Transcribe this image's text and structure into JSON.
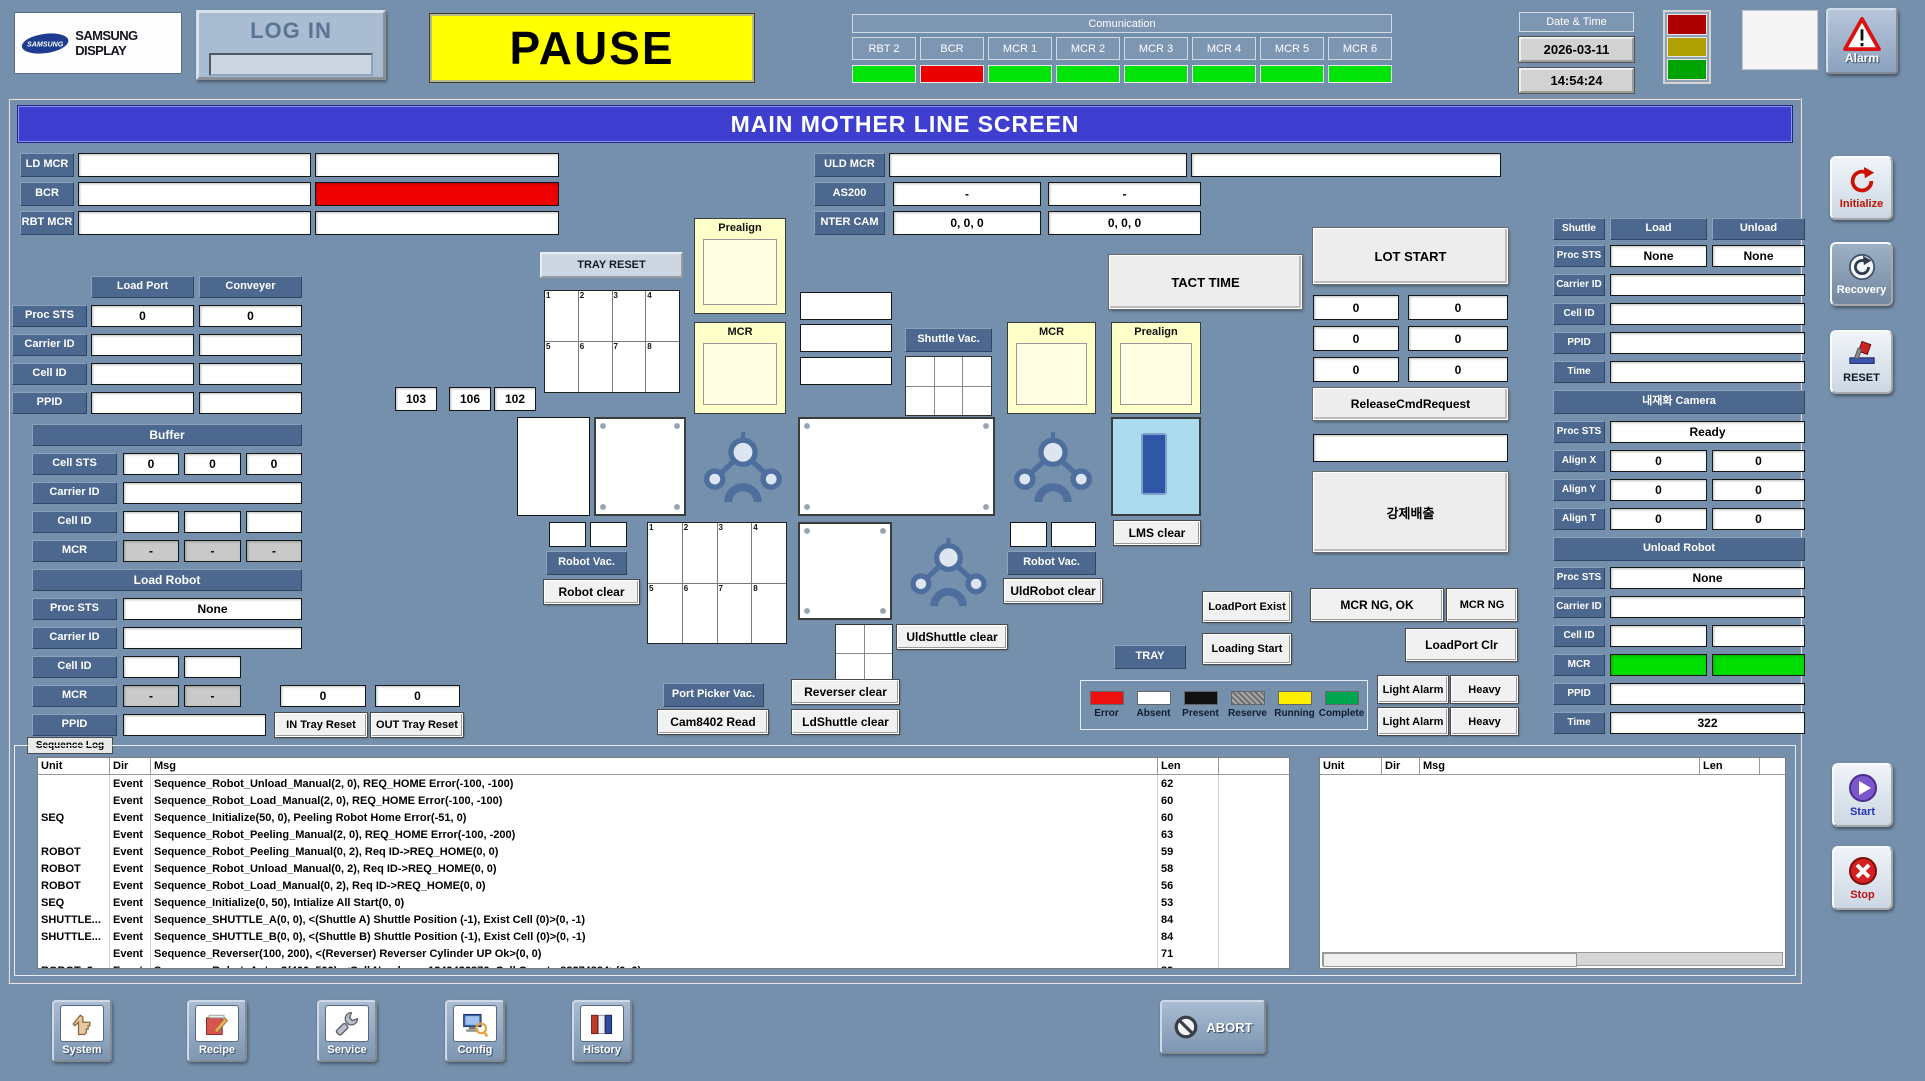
{
  "header": {
    "logo": {
      "oval_text": "SAMSUNG",
      "brand": "SAMSUNG DISPLAY"
    },
    "login_label": "LOG IN",
    "run_status": "PAUSE",
    "comm": {
      "title": "Comunication",
      "channels": [
        {
          "label": "RBT 2",
          "state": "ok"
        },
        {
          "label": "BCR",
          "state": "error"
        },
        {
          "label": "MCR 1",
          "state": "ok"
        },
        {
          "label": "MCR 2",
          "state": "ok"
        },
        {
          "label": "MCR 3",
          "state": "ok"
        },
        {
          "label": "MCR 4",
          "state": "ok"
        },
        {
          "label": "MCR 5",
          "state": "ok"
        },
        {
          "label": "MCR 6",
          "state": "ok"
        }
      ]
    },
    "datetime": {
      "title": "Date & Time",
      "date": "2026-03-11",
      "time": "14:54:24"
    },
    "alarm_label": "Alarm"
  },
  "title": "MAIN MOTHER LINE SCREEN",
  "id_rows": {
    "ld_mcr": {
      "label": "LD MCR",
      "v1": "",
      "v2": ""
    },
    "bcr": {
      "label": "BCR",
      "v1": "",
      "v2": ""
    },
    "rbt_mcr": {
      "label": "RBT MCR",
      "v1": "",
      "v2": ""
    },
    "uld_mcr": {
      "label": "ULD MCR",
      "v1": "",
      "v2": ""
    },
    "as200": {
      "label": "AS200",
      "v1": "-",
      "v2": "-"
    },
    "nter_cam": {
      "label": "NTER CAM",
      "v1": "0, 0, 0",
      "v2": "0, 0, 0"
    }
  },
  "load_port": {
    "col1": "Load Port",
    "col2": "Conveyer",
    "proc_sts_label": "Proc STS",
    "carrier_id_label": "Carrier ID",
    "cell_id_label": "Cell ID",
    "ppid_label": "PPID",
    "proc_sts": [
      "0",
      "0"
    ]
  },
  "buffer": {
    "title": "Buffer",
    "cell_sts_label": "Cell STS",
    "carrier_id_label": "Carrier ID",
    "cell_id_label": "Cell ID",
    "mcr_label": "MCR",
    "cell_sts": [
      "0",
      "0",
      "0"
    ],
    "mcr": [
      "-",
      "-",
      "-"
    ]
  },
  "load_robot": {
    "title": "Load Robot",
    "proc_sts_label": "Proc STS",
    "carrier_id_label": "Carrier ID",
    "cell_id_label": "Cell ID",
    "mcr_label": "MCR",
    "ppid_label": "PPID",
    "proc_sts": "None",
    "mcr": [
      "-",
      "-"
    ],
    "counts": [
      "0",
      "0"
    ],
    "in_tray_reset": "IN Tray Reset",
    "out_tray_reset": "OUT Tray Reset"
  },
  "diagram": {
    "tray_reset": "TRAY RESET",
    "tray_cells": [
      "1",
      "2",
      "3",
      "4",
      "5",
      "6",
      "7",
      "8"
    ],
    "port_numbers": [
      "103",
      "106",
      "102"
    ],
    "prealign": "Prealign",
    "mcr": "MCR",
    "shuttle_vac": "Shuttle Vac.",
    "tact_time": "TACT TIME",
    "lms_clear": "LMS clear",
    "robot_vac": "Robot Vac.",
    "robot_clear": "Robot clear",
    "uldrobot_clear": "UldRobot clear",
    "uldshuttle_clear": "UldShuttle clear",
    "ldshuttle_clear": "LdShuttle clear",
    "reverser_clear": "Reverser clear",
    "port_picker_vac": "Port Picker Vac.",
    "cam_read": "Cam8402 Read",
    "tray": "TRAY",
    "loadport_exist": "LoadPort Exist",
    "loading_start": "Loading Start",
    "mcr_ng_ok": "MCR NG, OK",
    "mcr_ng": "MCR NG",
    "loadport_clr": "LoadPort Clr",
    "light_alarm": "Light Alarm",
    "heavy": "Heavy"
  },
  "legend": {
    "items": [
      {
        "label": "Error",
        "color": "#ee1111"
      },
      {
        "label": "Absent",
        "color": "#ffffff"
      },
      {
        "label": "Present",
        "color": "#111111"
      },
      {
        "label": "Reserve",
        "color": "#909090",
        "pattern": "hatch"
      },
      {
        "label": "Running",
        "color": "#ffee00"
      },
      {
        "label": "Complete",
        "color": "#00a550"
      }
    ]
  },
  "lot": {
    "lot_start": "LOT START",
    "counters": [
      "0",
      "0",
      "0",
      "0",
      "0",
      "0"
    ],
    "release": "ReleaseCmdRequest",
    "request_value": "",
    "force_eject": "강제배출"
  },
  "shuttle": {
    "title": "Shuttle",
    "load": "Load",
    "unload": "Unload",
    "proc_sts_label": "Proc STS",
    "carrier_id_label": "Carrier ID",
    "cell_id_label": "Cell ID",
    "ppid_label": "PPID",
    "time_label": "Time",
    "proc_sts_load": "None",
    "proc_sts_unload": "None",
    "carrier_id": "",
    "cell_id": "",
    "ppid": "",
    "time": ""
  },
  "camera": {
    "title": "내재화 Camera",
    "proc_sts_label": "Proc STS",
    "proc_sts": "Ready",
    "align_x_label": "Align X",
    "align_y_label": "Align Y",
    "align_t_label": "Align T",
    "align_x": [
      "0",
      "0"
    ],
    "align_y": [
      "0",
      "0"
    ],
    "align_t": [
      "0",
      "0"
    ]
  },
  "unload_robot": {
    "title": "Unload Robot",
    "proc_sts_label": "Proc STS",
    "carrier_id_label": "Carrier ID",
    "cell_id_label": "Cell ID",
    "mcr_label": "MCR",
    "ppid_label": "PPID",
    "time_label": "Time",
    "proc_sts": "None",
    "carrier_id": "",
    "ppid": "",
    "time": "322"
  },
  "log": {
    "tab": "Sequence Log",
    "headers": {
      "unit": "Unit",
      "dir": "Dir",
      "msg": "Msg",
      "len": "Len"
    },
    "rows": [
      {
        "unit": "",
        "dir": "Event",
        "msg": "Sequence_Robot_Unload_Manual(2, 0), REQ_HOME Error(-100, -100)",
        "len": "62"
      },
      {
        "unit": "",
        "dir": "Event",
        "msg": "Sequence_Robot_Load_Manual(2, 0), REQ_HOME Error(-100, -100)",
        "len": "60"
      },
      {
        "unit": "SEQ",
        "dir": "Event",
        "msg": "Sequence_Initialize(50, 0), Peeling Robot Home Error(-51, 0)",
        "len": "60"
      },
      {
        "unit": "",
        "dir": "Event",
        "msg": "Sequence_Robot_Peeling_Manual(2, 0), REQ_HOME Error(-100, -200)",
        "len": "63"
      },
      {
        "unit": "ROBOT",
        "dir": "Event",
        "msg": "Sequence_Robot_Peeling_Manual(0, 2), Req ID->REQ_HOME(0, 0)",
        "len": "59"
      },
      {
        "unit": "ROBOT",
        "dir": "Event",
        "msg": "Sequence_Robot_Unload_Manual(0, 2), Req ID->REQ_HOME(0, 0)",
        "len": "58"
      },
      {
        "unit": "ROBOT",
        "dir": "Event",
        "msg": "Sequence_Robot_Load_Manual(0, 2), Req ID->REQ_HOME(0, 0)",
        "len": "56"
      },
      {
        "unit": "SEQ",
        "dir": "Event",
        "msg": "Sequence_Initialize(0, 50), Intialize All Start(0, 0)",
        "len": "53"
      },
      {
        "unit": "SHUTTLE...",
        "dir": "Event",
        "msg": "Sequence_SHUTTLE_A(0, 0), <(Shuttle A) Shuttle Position (-1), Exist Cell (0)>(0, -1)",
        "len": "84"
      },
      {
        "unit": "SHUTTLE...",
        "dir": "Event",
        "msg": "Sequence_SHUTTLE_B(0, 0), <(Shuttle B) Shuttle Position (-1), Exist Cell (0)>(0, -1)",
        "len": "84"
      },
      {
        "unit": "",
        "dir": "Event",
        "msg": "Sequence_Reverser(100, 200), <(Reverser) Reverser Cylinder UP Ok>(0, 0)",
        "len": "71"
      },
      {
        "unit": "ROBOT_3",
        "dir": "Event",
        "msg": "Sequence_Robot_Auto_3(400, 500), <Cell Number : -1349426876, Cell Count : 88274884>(0, 0)",
        "len": "89"
      }
    ]
  },
  "nav": {
    "system": "System",
    "recipe": "Recipe",
    "service": "Service",
    "config": "Config",
    "history": "History",
    "abort": "ABORT"
  },
  "side": {
    "initialize": "Initialize",
    "recovery": "Recovery",
    "reset": "RESET",
    "start": "Start",
    "stop": "Stop"
  }
}
